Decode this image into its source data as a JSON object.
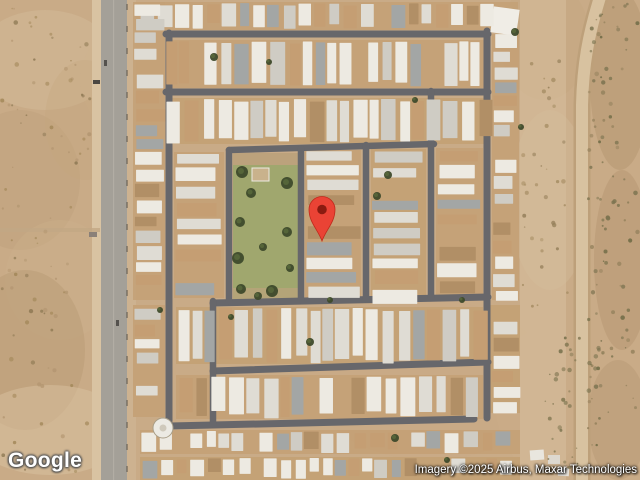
{
  "map": {
    "view_type": "satellite",
    "logo_text": "Google",
    "attribution": "Imagery ©2025 Airbus, Maxar Technologies",
    "marker": {
      "x": 322,
      "y": 243,
      "body_color": "#EA4335",
      "border_color": "#C0291B",
      "dot_color": "#8A1B10"
    },
    "palette": {
      "desert_base": "#c9ab87",
      "lot": "#c4a176",
      "street": "#67676b",
      "park_grass": "#a0a76e",
      "park_dirt": "#bca27c",
      "tree_dark": "#3e4a2b",
      "tree_light": "#5a6a3c",
      "home_palette": [
        [
          "#edeae2",
          0.36
        ],
        [
          "#dfdcd4",
          0.22
        ],
        [
          "#cfccc4",
          0.12
        ],
        [
          "#c59e73",
          0.14
        ],
        [
          "#b18f66",
          0.08
        ],
        [
          "#a3a6a5",
          0.08
        ]
      ]
    },
    "features": {
      "tone_patches": [
        {
          "cx": 45,
          "cy": 60,
          "rx": 70,
          "ry": 50,
          "fill": "#d8c2a1",
          "op": 0.35
        },
        {
          "cx": 20,
          "cy": 180,
          "rx": 60,
          "ry": 70,
          "fill": "#bb9d77",
          "op": 0.3
        },
        {
          "cx": 60,
          "cy": 280,
          "rx": 55,
          "ry": 60,
          "fill": "#cdb28e",
          "op": 0.3
        },
        {
          "cx": 25,
          "cy": 350,
          "rx": 60,
          "ry": 80,
          "fill": "#b2946d",
          "op": 0.35
        },
        {
          "cx": 50,
          "cy": 430,
          "rx": 80,
          "ry": 45,
          "fill": "#dcc6a5",
          "op": 0.45
        },
        {
          "cx": 85,
          "cy": 120,
          "rx": 40,
          "ry": 60,
          "fill": "#c3a77f",
          "op": 0.3
        },
        {
          "cx": 545,
          "cy": 40,
          "rx": 45,
          "ry": 60,
          "fill": "#c2a67f",
          "op": 0.35
        },
        {
          "cx": 550,
          "cy": 200,
          "rx": 40,
          "ry": 90,
          "fill": "#d5bd9b",
          "op": 0.4
        },
        {
          "cx": 540,
          "cy": 400,
          "rx": 45,
          "ry": 70,
          "fill": "#cdb08a",
          "op": 0.3
        },
        {
          "cx": 620,
          "cy": 80,
          "rx": 30,
          "ry": 90,
          "fill": "#b0916a",
          "op": 0.4
        },
        {
          "cx": 622,
          "cy": 260,
          "rx": 28,
          "ry": 90,
          "fill": "#ab8d66",
          "op": 0.35
        },
        {
          "cx": 618,
          "cy": 420,
          "rx": 30,
          "ry": 60,
          "fill": "#b59671",
          "op": 0.4
        },
        {
          "cx": 300,
          "cy": 240,
          "rx": 180,
          "ry": 160,
          "fill": "#cfb28c",
          "op": 0.08
        },
        {
          "cx": 200,
          "cy": 80,
          "rx": 120,
          "ry": 80,
          "fill": "#d2b791",
          "op": 0.07
        },
        {
          "cx": 430,
          "cy": 380,
          "rx": 120,
          "ry": 80,
          "fill": "#c9a981",
          "op": 0.08
        }
      ],
      "road_left": {
        "shoulder_l": {
          "x": 92,
          "w": 10,
          "fill": "#d9c3a2"
        },
        "asphalt": {
          "x": 101,
          "w": 26,
          "fill": "#a4a098"
        },
        "median": {
          "x": 113,
          "w": 1.2,
          "fill": "#b5b0a8"
        },
        "shoulder_r": {
          "x": 127,
          "w": 9,
          "fill": "#cdb290"
        },
        "track": {
          "y": 228,
          "h": 4,
          "w": 100,
          "fill": "#c2a784"
        },
        "pole_x": 126,
        "pole_step": 22,
        "pole_fill": "#6b6257",
        "objects": [
          {
            "x": 93,
            "y": 80,
            "w": 7,
            "h": 4,
            "fill": "#4a4742"
          },
          {
            "x": 89,
            "y": 232,
            "w": 8,
            "h": 5,
            "fill": "#8a8078"
          },
          {
            "x": 104,
            "y": 60,
            "w": 3,
            "h": 6,
            "fill": "#55524e"
          },
          {
            "x": 116,
            "y": 320,
            "w": 3,
            "h": 6,
            "fill": "#55524e"
          }
        ]
      },
      "road_right": {
        "outer": {
          "d": "M601,-6 C588,35 583,65 582,105 L582,486",
          "w": 17,
          "stroke": "#bda07a"
        },
        "inner": {
          "d": "M601,-6 C588,35 583,65 582,105 L582,486",
          "w": 12,
          "stroke": "#d8c2a0"
        },
        "side_strip": {
          "x": 520,
          "w": 46,
          "fill": "#d7bf9e",
          "op": 0.55
        }
      },
      "streets": [
        {
          "d": "M166,34 H488",
          "w": 7
        },
        {
          "d": "M166,92 H488",
          "w": 7
        },
        {
          "d": "M229,150 L434,144",
          "w": 6.5
        },
        {
          "d": "M213,303 L488,297",
          "w": 7
        },
        {
          "d": "M213,371 L488,362",
          "w": 7
        },
        {
          "d": "M170,426 L474,419",
          "w": 7
        },
        {
          "d": "M169,33 V421",
          "w": 7
        },
        {
          "d": "M229,150 V301",
          "w": 6.5
        },
        {
          "d": "M213,301 V424",
          "w": 6.5
        },
        {
          "d": "M301,149 V300",
          "w": 6.5
        },
        {
          "d": "M366,145 V299",
          "w": 6.5
        },
        {
          "d": "M431,91 V298",
          "w": 6.5
        },
        {
          "d": "M487,31 V418",
          "w": 7
        }
      ],
      "park": {
        "x": 233,
        "y": 153,
        "w": 65,
        "h": 146,
        "dirt_top_h": 12,
        "dirt_bottom_h": 11,
        "trees": [
          {
            "x": 242,
            "y": 172,
            "r": 6
          },
          {
            "x": 251,
            "y": 193,
            "r": 5
          },
          {
            "x": 287,
            "y": 183,
            "r": 6
          },
          {
            "x": 240,
            "y": 222,
            "r": 5
          },
          {
            "x": 287,
            "y": 232,
            "r": 5
          },
          {
            "x": 263,
            "y": 247,
            "r": 4
          },
          {
            "x": 238,
            "y": 258,
            "r": 6
          },
          {
            "x": 241,
            "y": 289,
            "r": 5
          },
          {
            "x": 272,
            "y": 291,
            "r": 6
          },
          {
            "x": 290,
            "y": 268,
            "r": 4
          },
          {
            "x": 258,
            "y": 296,
            "r": 4
          }
        ]
      },
      "structures": [
        {
          "x": 492,
          "y": 8,
          "w": 26,
          "h": 26,
          "fill": "#f0ede6",
          "rot": 8
        },
        {
          "x": 252,
          "y": 168,
          "w": 17,
          "h": 13,
          "fill": "#c9b28c",
          "rot": 0,
          "stroke": "#eceae2"
        },
        {
          "x": 530,
          "y": 450,
          "w": 14,
          "h": 10,
          "fill": "#e9e6de",
          "rot": -4
        },
        {
          "x": 548,
          "y": 455,
          "w": 12,
          "h": 9,
          "fill": "#ddd8cf",
          "rot": 0
        },
        {
          "x": 538,
          "y": 466,
          "w": 16,
          "h": 9,
          "fill": "#c9a87c",
          "rot": 0
        },
        {
          "x": 558,
          "y": 468,
          "w": 11,
          "h": 8,
          "fill": "#e6e2da",
          "rot": 3
        }
      ],
      "tank": {
        "cx": 163,
        "cy": 428,
        "r": 10,
        "fill": "#eceae3",
        "ring": "#a99e87",
        "inner": "#cfc9bb"
      },
      "home_regions": [
        {
          "x": 140,
          "y": 2,
          "w": 378,
          "h": 28,
          "o": "v"
        },
        {
          "x": 166,
          "y": 40,
          "w": 322,
          "h": 48,
          "o": "v"
        },
        {
          "x": 166,
          "y": 98,
          "w": 322,
          "h": 46,
          "o": "v"
        },
        {
          "x": 174,
          "y": 152,
          "w": 50,
          "h": 146,
          "o": "h"
        },
        {
          "x": 305,
          "y": 150,
          "w": 56,
          "h": 148,
          "o": "h"
        },
        {
          "x": 371,
          "y": 149,
          "w": 55,
          "h": 148,
          "o": "h"
        },
        {
          "x": 436,
          "y": 148,
          "w": 47,
          "h": 148,
          "o": "h"
        },
        {
          "x": 492,
          "y": 34,
          "w": 27,
          "h": 266,
          "o": "h"
        },
        {
          "x": 176,
          "y": 307,
          "w": 307,
          "h": 57,
          "o": "v"
        },
        {
          "x": 176,
          "y": 375,
          "w": 307,
          "h": 44,
          "o": "v"
        },
        {
          "x": 140,
          "y": 430,
          "w": 380,
          "h": 24,
          "o": "v"
        },
        {
          "x": 140,
          "y": 457,
          "w": 380,
          "h": 23,
          "o": "v"
        },
        {
          "x": 133,
          "y": 2,
          "w": 32,
          "h": 298,
          "o": "h"
        },
        {
          "x": 133,
          "y": 305,
          "w": 32,
          "h": 112,
          "o": "h"
        },
        {
          "x": 490,
          "y": 305,
          "w": 30,
          "h": 108,
          "o": "h"
        }
      ],
      "neighborhood_trees": [
        {
          "x": 214,
          "y": 57,
          "r": 4
        },
        {
          "x": 269,
          "y": 62,
          "r": 3
        },
        {
          "x": 388,
          "y": 175,
          "r": 4
        },
        {
          "x": 377,
          "y": 196,
          "r": 4
        },
        {
          "x": 310,
          "y": 342,
          "r": 4
        },
        {
          "x": 415,
          "y": 100,
          "r": 3
        },
        {
          "x": 515,
          "y": 32,
          "r": 4
        },
        {
          "x": 521,
          "y": 127,
          "r": 3
        },
        {
          "x": 395,
          "y": 438,
          "r": 4
        },
        {
          "x": 330,
          "y": 300,
          "r": 3
        },
        {
          "x": 231,
          "y": 317,
          "r": 3
        },
        {
          "x": 462,
          "y": 300,
          "r": 3
        },
        {
          "x": 160,
          "y": 310,
          "r": 3
        },
        {
          "x": 447,
          "y": 460,
          "r": 3
        }
      ],
      "speckle_zones": [
        {
          "x": 2,
          "y": 5,
          "w": 90,
          "h": 470,
          "n": 90,
          "colors": [
            "#a28758",
            "#8f7a55",
            "#b39671"
          ]
        },
        {
          "x": 588,
          "y": 0,
          "w": 50,
          "h": 478,
          "n": 110,
          "colors": [
            "#6f6b46",
            "#7d7451",
            "#95825d"
          ]
        },
        {
          "x": 522,
          "y": 60,
          "w": 48,
          "h": 250,
          "n": 35,
          "colors": [
            "#a88f66",
            "#97815c"
          ]
        },
        {
          "x": 545,
          "y": 330,
          "w": 38,
          "h": 140,
          "n": 30,
          "colors": [
            "#7f7550",
            "#6f6b46"
          ]
        }
      ]
    }
  }
}
